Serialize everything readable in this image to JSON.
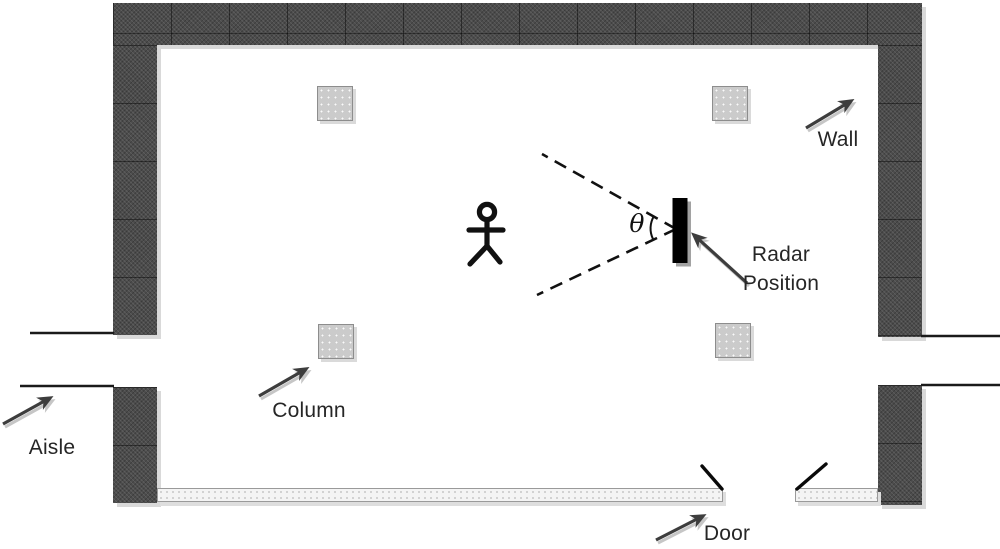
{
  "labels": {
    "wall": "Wall",
    "radar_position_line1": "Radar",
    "radar_position_line2": "Position",
    "column": "Column",
    "aisle": "Aisle",
    "door": "Door",
    "theta": "θ"
  },
  "colors": {
    "background": "#ffffff",
    "wall_fill": "#4c4c4c",
    "wall_shadow": "#d9d9d9",
    "column_fill": "#cbcbcb",
    "column_border": "#8d8d8d",
    "floor_bar_fill": "#f4f4f4",
    "radar_fill": "#000000",
    "beam_line": "#111111",
    "arrow": "#3d3d3d",
    "text": "#262626"
  }
}
